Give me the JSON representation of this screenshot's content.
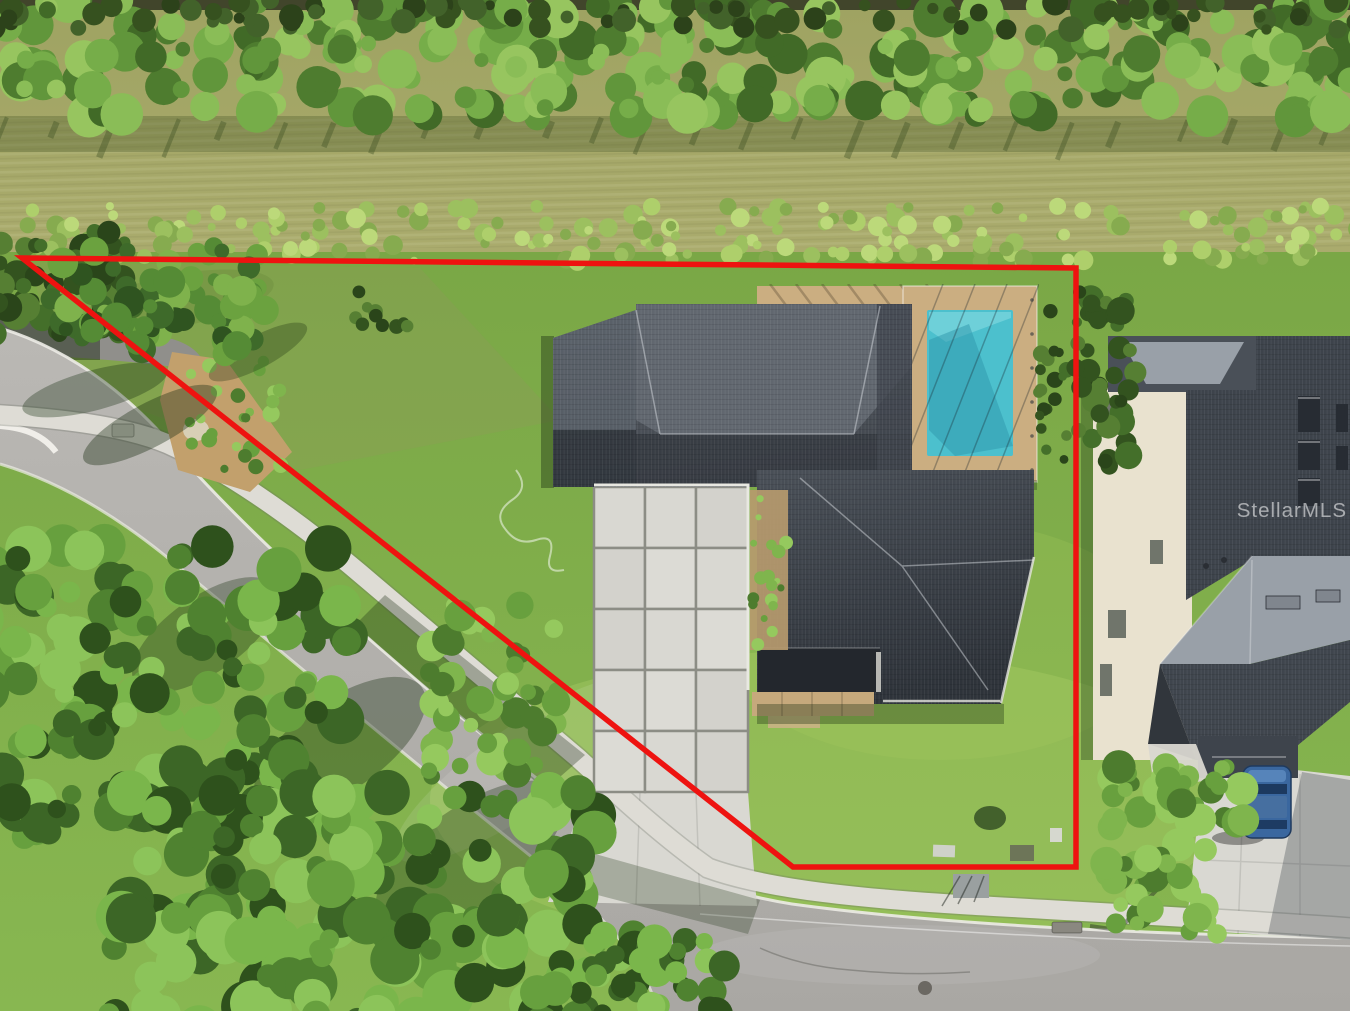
{
  "watermark": {
    "text": "StellarMLS"
  },
  "colors": {
    "boundary_red": "#ee1310",
    "pool_water": "#4cc0cd",
    "pool_shadow": "#2e95ab",
    "paver_deck": "#cbae81",
    "mulch_tan": "#c2a06c",
    "stone_path": "#c6a97c",
    "roof_dark": "#3a3f46",
    "roof_light": "#646a72",
    "neighbor_roof_top": "#99a0a8",
    "neighbor_wall": "#e9e2cf",
    "concrete": "#d9d8d2",
    "concrete_joint": "#8c8d85",
    "road_asphalt": "#b4b2ae",
    "curb_white": "#efede7",
    "sidewalk": "#dedcd5",
    "lawn_green": "#7faa4a",
    "field_olive": "#a4a566",
    "tree_green": "#4f8230",
    "car_blue": "#3a679f",
    "watermark_white": "#ffffff"
  },
  "palettes": {
    "hedge": [
      "#4e7c2f",
      "#61963b",
      "#76ad49",
      "#8abd57",
      "#416a27",
      "#97c55f"
    ],
    "hedge_dark": [
      "#36511f",
      "#2c421a",
      "#42622a"
    ],
    "tufts": [
      "#9cc05f",
      "#aecf6b",
      "#86ab4f",
      "#bcd97a"
    ],
    "palms": [
      "#3e6a2a",
      "#558b35",
      "#6ba23f",
      "#2f5420",
      "#7fb24c"
    ],
    "shrub_dark": [
      "#33531f",
      "#446f2a",
      "#567f33",
      "#2a451a"
    ],
    "canopy": [
      "#3c6626",
      "#4f8230",
      "#67a03e",
      "#7ab64b",
      "#2e511c",
      "#8cc45a"
    ],
    "bright_tree": [
      "#4d7c2e",
      "#68a03e",
      "#7fb54d",
      "#95c95e"
    ]
  }
}
